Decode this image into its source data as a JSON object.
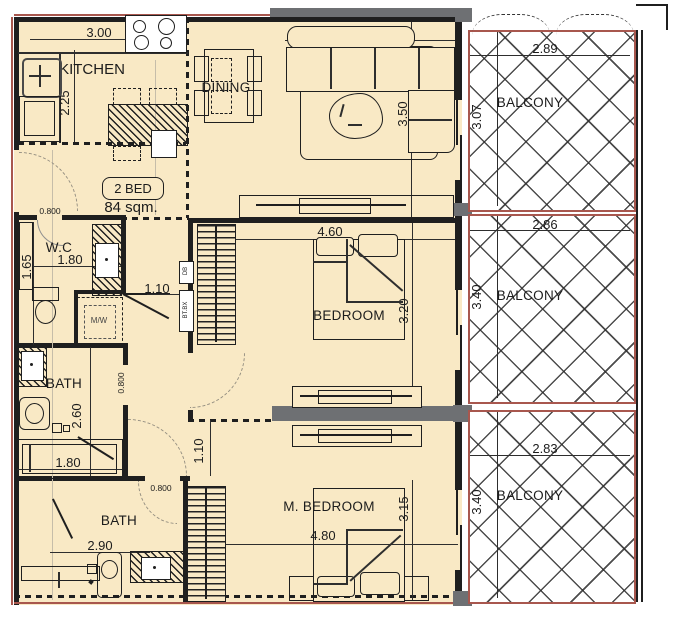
{
  "unit": {
    "badge": "2 BED",
    "area": "84 sqm."
  },
  "rooms": {
    "kitchen": {
      "label": "KITCHEN",
      "width": "3.00",
      "depth": "2.25"
    },
    "dining": {
      "label": "DINING"
    },
    "living": {
      "label": "LIVING",
      "width": "4.80",
      "depth": "3.50"
    },
    "wc": {
      "label": "W.C",
      "width": "1.80",
      "depth": "1.65"
    },
    "bedroom": {
      "label": "BEDROOM",
      "width": "4.60",
      "depth": "3.20"
    },
    "bath1": {
      "label": "BATH",
      "width": "1.80",
      "depth": "2.60"
    },
    "bath2": {
      "label": "BATH",
      "width": "2.90"
    },
    "master": {
      "label": "M. BEDROOM",
      "width": "4.80",
      "depth": "3.15"
    },
    "balcony1": {
      "label": "BALCONY",
      "width": "2.89",
      "depth": "3.07"
    },
    "balcony2": {
      "label": "BALCONY",
      "width": "2.86",
      "depth": "3.40"
    },
    "balcony3": {
      "label": "BALCONY",
      "width": "2.83",
      "depth": "3.40"
    }
  },
  "doors": {
    "wc": "0.800",
    "bath1": "0.800",
    "bath2": "0.800"
  },
  "corridors": {
    "hall": "1.10",
    "master": "1.10"
  },
  "equipment": {
    "washer": "M/W",
    "db": "DB",
    "telecom": "BT.BX"
  },
  "colors": {
    "floor": "#f9e9c5",
    "wall": "#1f1f1f",
    "balcony_border": "#a8574e",
    "slab": "#6e7073"
  }
}
